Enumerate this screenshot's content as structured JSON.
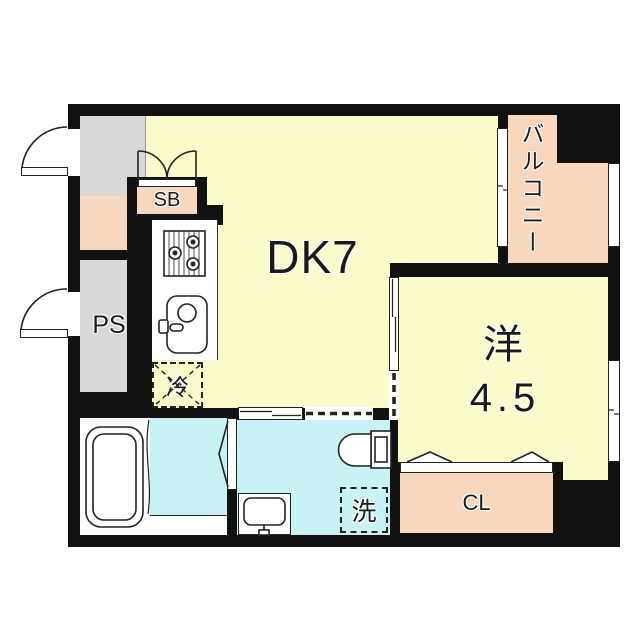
{
  "title": "apartment-floor-plan",
  "rooms": {
    "dining_kitchen": {
      "label": "DK7"
    },
    "western_room": {
      "label": "洋",
      "area": "4.5"
    },
    "balcony": {
      "label": "バルコニー"
    },
    "shoe_box": {
      "label": "SB"
    },
    "pipe_space": {
      "label": "PS"
    },
    "closet": {
      "label": "CL"
    }
  },
  "fixtures": {
    "refrigerator": {
      "label": "冷"
    },
    "laundry_machine": {
      "label": "洗"
    }
  },
  "colors": {
    "wall": "#111111",
    "room_yellow": "#FAFACB",
    "balcony_peach": "#F7D8BE",
    "entrance_gray": "#D8D8D8",
    "wet_area_cyan": "#C9F2F4",
    "line": "#222222"
  }
}
